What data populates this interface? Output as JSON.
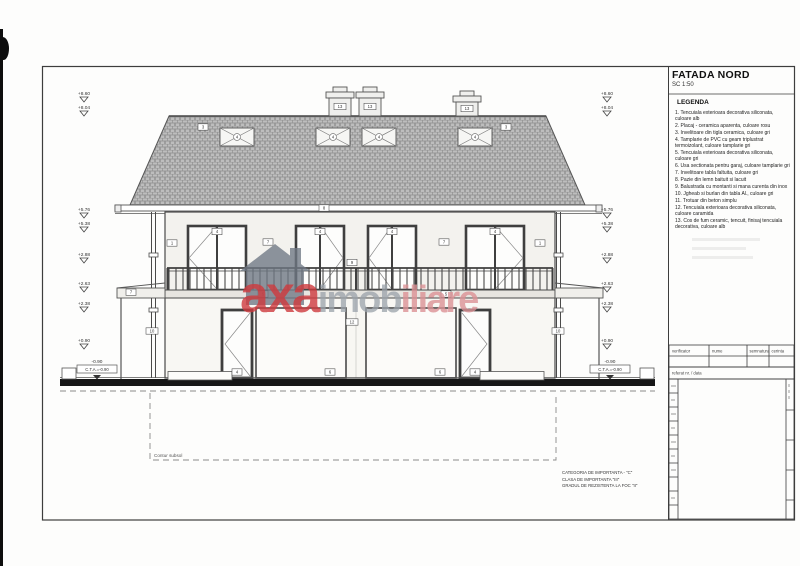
{
  "sheet": {
    "title": "FATADA NORD",
    "scale": "SC 1:50",
    "legend_heading": "LEGENDA",
    "legend_items": [
      "1. Tencuiala exterioara decorativa siliconata, culoare alb",
      "2. Placaj - ceramica aparenta, culoare rosu",
      "3. Invelitoare din tigla ceramica, culoare gri",
      "4. Tamplarie de PVC cu geam triplustrat termoizolant, culoare tamplarie gri",
      "5. Tencuiala exterioara decorativa siliconata, culoare gri",
      "6. Usa sectionata pentru garaj, culoare tamplarie gri",
      "7. Invelitoare tabla faltuita, culoare gri",
      "8. Pazie din lemn baituit si lacuit",
      "9. Balustrada cu montanti si mana curenta din inox",
      "10. Jgheab si burlan din tabla Al., culoare gri",
      "11. Trotuar din beton simplu",
      "12. Tencuiala exterioara decorativa siliconata, culoare caramida",
      "13. Cos de fum ceramic, tencuit, finisaj tencuiala decorativa, culoare alb"
    ],
    "title_table": {
      "verificator": "verificator",
      "nume": "nume",
      "semnatura": "semnatura",
      "cerinta": "cerinta",
      "referat": "referat nr. / data"
    },
    "notes": [
      "CATEGORIA DE IMPORTANTA - \"C\"",
      "CLASA DE IMPORTANTA \"III\"",
      "GRADUL DE REZISTENTA LA FOC \"II\""
    ]
  },
  "watermark": {
    "part1": "axa",
    "part2": "imob",
    "part3": "iliare"
  },
  "drawing": {
    "basement_label": "Contur subsol",
    "levels": {
      "l860": "+8.60",
      "l804": "+8.04",
      "l576": "+5.76",
      "l538": "+5.38",
      "l288": "+2.88",
      "l263": "+2.63",
      "l238": "+2.38",
      "l090": "+0.90",
      "cta_value": "-0.90",
      "cta_label": "C.T.A.=-0.90"
    },
    "callouts": {
      "c1": "1",
      "c2": "2",
      "c3": "3",
      "c4": "4",
      "c5": "5",
      "c6": "6",
      "c7": "7",
      "c8": "8",
      "c9": "9",
      "c10": "10",
      "c11": "11",
      "c12": "12",
      "c13": "13"
    }
  },
  "colors": {
    "brand_red": "#cf3a3e",
    "brand_gray": "#9aa2aa",
    "line": "#4a4a4a"
  }
}
